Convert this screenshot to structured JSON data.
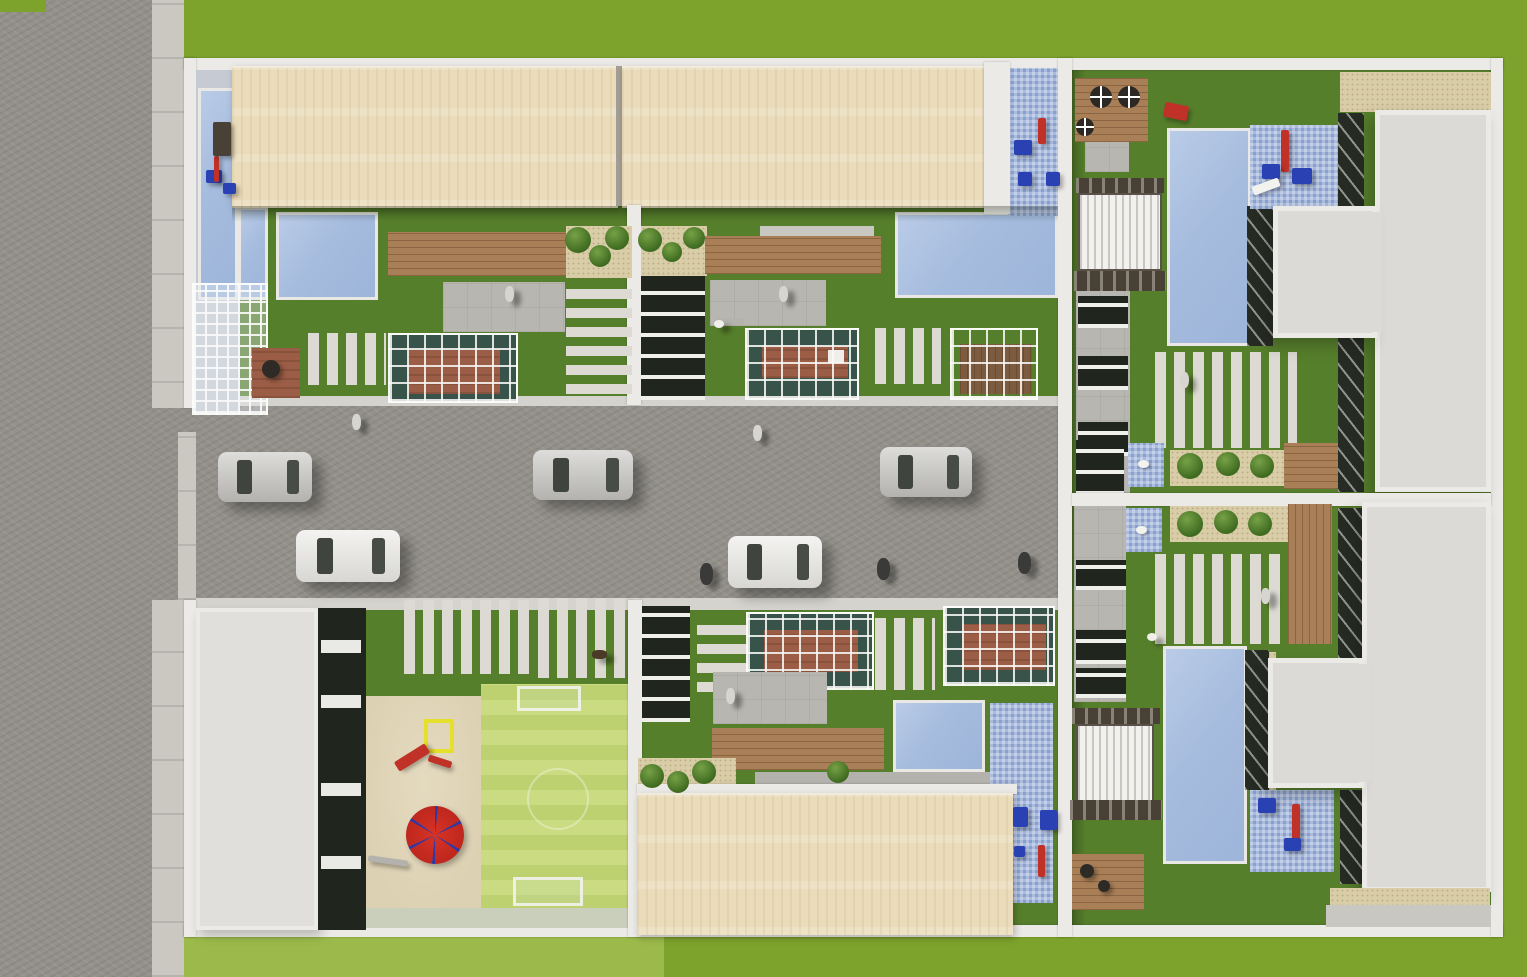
{
  "meta": {
    "description": "Top-down aerial 3D architectural rendering of a gated residential complex: two rows of townhouses along a central private street with cars, communal playground with red carousel and mini football pitch, private gardens with pools, pergolas, wooden decks and white slat walkways; public road and sidewalk on the left edge, lawn surrounding the site.",
    "image_type": "3d-render-aerial",
    "visible_text": ""
  },
  "palette": {
    "grass": "#7da32c",
    "grassLight": "#9cba4b",
    "lawn": "#567f2b",
    "asphalt": "#94918b",
    "walk": "#cbc8c1",
    "wall": "#eceae7",
    "terrace": "#c6cbd3",
    "roofBeige": "#eadcba",
    "roofWhite": "#dbdad7",
    "roofWhiteEdge": "#eceae7",
    "pool": "#a6bcde",
    "splash": "#a9bbdf",
    "deck": "#a97f57",
    "patio": "#b8b6b1",
    "gravel": "#d9cda7",
    "darkGlass": "#20251d",
    "slat": "#dcdad2",
    "pitch": "#bdd171",
    "pitchStripe": "#cadb81",
    "sand": "#ddd1b3",
    "sandboxYellow": "#e4e02b",
    "carouselRed": "#c9291e",
    "playBlue": "#2a41b4",
    "playRed": "#c03227",
    "brick": "#9b5d45",
    "louver": "#f2f1ee",
    "frameDark": "#4a4136",
    "stepGray": "#c9c7c2",
    "stepGray2": "#b4b2ad",
    "carSilver": "#c2c1bd",
    "carWhite": "#eae9e5",
    "figLight": "#d6d5d0",
    "figDark": "#3a3a38",
    "swan": "#f2f2ee"
  },
  "inventory": {
    "cars_on_street": 5,
    "building_blocks": 4,
    "beige_roof_rows": 2,
    "white_villa_roofs": 2,
    "pools_and_water_features": 10,
    "pergolas_with_louvers": 2,
    "playgrounds": 4,
    "mini_football_pitch": 1,
    "red_carousel": 1
  },
  "cars": [
    {
      "x": 218,
      "y": 452,
      "w": 94,
      "h": 50,
      "color": "carSilver"
    },
    {
      "x": 296,
      "y": 530,
      "w": 104,
      "h": 52,
      "color": "carWhite"
    },
    {
      "x": 533,
      "y": 450,
      "w": 100,
      "h": 50,
      "color": "carSilver"
    },
    {
      "x": 728,
      "y": 536,
      "w": 94,
      "h": 52,
      "color": "carWhite"
    },
    {
      "x": 880,
      "y": 447,
      "w": 92,
      "h": 50,
      "color": "carSilver"
    }
  ],
  "people": [
    {
      "x": 352,
      "y": 414,
      "kind": "pedestrian-light"
    },
    {
      "x": 753,
      "y": 425,
      "kind": "pedestrian-light"
    },
    {
      "x": 700,
      "y": 563,
      "kind": "rider-dark"
    },
    {
      "x": 877,
      "y": 558,
      "kind": "rider-dark"
    },
    {
      "x": 1018,
      "y": 552,
      "kind": "rider-dark"
    },
    {
      "x": 505,
      "y": 286,
      "kind": "pedestrian-light"
    },
    {
      "x": 779,
      "y": 286,
      "kind": "pedestrian-light"
    },
    {
      "x": 726,
      "y": 688,
      "kind": "pedestrian-light"
    },
    {
      "x": 1180,
      "y": 372,
      "kind": "pedestrian-light"
    },
    {
      "x": 1261,
      "y": 588,
      "kind": "pedestrian-light"
    },
    {
      "x": 592,
      "y": 650,
      "kind": "dog"
    },
    {
      "x": 714,
      "y": 320,
      "kind": "bird"
    },
    {
      "x": 1147,
      "y": 633,
      "kind": "bird"
    }
  ],
  "bushes": [
    {
      "x": 578,
      "y": 240,
      "r": 13
    },
    {
      "x": 600,
      "y": 256,
      "r": 11
    },
    {
      "x": 617,
      "y": 238,
      "r": 12
    },
    {
      "x": 650,
      "y": 240,
      "r": 12
    },
    {
      "x": 672,
      "y": 252,
      "r": 10
    },
    {
      "x": 694,
      "y": 238,
      "r": 11
    },
    {
      "x": 652,
      "y": 776,
      "r": 12
    },
    {
      "x": 678,
      "y": 782,
      "r": 11
    },
    {
      "x": 704,
      "y": 772,
      "r": 12
    },
    {
      "x": 1190,
      "y": 466,
      "r": 13
    },
    {
      "x": 1228,
      "y": 464,
      "r": 12
    },
    {
      "x": 1262,
      "y": 466,
      "r": 12
    },
    {
      "x": 1190,
      "y": 524,
      "r": 13
    },
    {
      "x": 1226,
      "y": 522,
      "r": 12
    },
    {
      "x": 1260,
      "y": 524,
      "r": 12
    },
    {
      "x": 838,
      "y": 772,
      "r": 11
    }
  ],
  "stairs": [
    {
      "x": 321,
      "y": 640
    },
    {
      "x": 321,
      "y": 695
    },
    {
      "x": 321,
      "y": 783
    },
    {
      "x": 321,
      "y": 856
    }
  ],
  "swans": [
    {
      "x": 1138,
      "y": 460
    },
    {
      "x": 1136,
      "y": 526
    }
  ],
  "tables": [
    {
      "x": 1090,
      "y": 86,
      "d": 22
    },
    {
      "x": 1118,
      "y": 86,
      "d": 22
    },
    {
      "x": 1076,
      "y": 118,
      "d": 18
    }
  ],
  "grills": [
    {
      "x": 262,
      "y": 360,
      "d": 18
    },
    {
      "x": 1080,
      "y": 864,
      "d": 14
    },
    {
      "x": 1098,
      "y": 880,
      "d": 12
    }
  ],
  "play_items": [
    {
      "x": 206,
      "y": 170,
      "w": 16,
      "h": 13,
      "c": "playBlue"
    },
    {
      "x": 214,
      "y": 156,
      "w": 5,
      "h": 26,
      "c": "playRed"
    },
    {
      "x": 223,
      "y": 183,
      "w": 13,
      "h": 11,
      "c": "playBlue"
    },
    {
      "x": 213,
      "y": 122,
      "w": 18,
      "h": 34,
      "c": "frameDark"
    },
    {
      "x": 1014,
      "y": 140,
      "w": 18,
      "h": 15,
      "c": "playBlue"
    },
    {
      "x": 1038,
      "y": 118,
      "w": 8,
      "h": 26,
      "c": "playRed"
    },
    {
      "x": 1018,
      "y": 172,
      "w": 14,
      "h": 14,
      "c": "playBlue"
    },
    {
      "x": 1046,
      "y": 172,
      "w": 14,
      "h": 14,
      "c": "playBlue"
    },
    {
      "x": 1281,
      "y": 130,
      "w": 8,
      "h": 42,
      "c": "playRed"
    },
    {
      "x": 1262,
      "y": 164,
      "w": 18,
      "h": 15,
      "c": "playBlue"
    },
    {
      "x": 1292,
      "y": 168,
      "w": 20,
      "h": 16,
      "c": "playBlue"
    },
    {
      "x": 1252,
      "y": 182,
      "w": 28,
      "h": 9,
      "c": "swan",
      "rot": -20
    },
    {
      "x": 1292,
      "y": 804,
      "w": 8,
      "h": 36,
      "c": "playRed"
    },
    {
      "x": 1258,
      "y": 798,
      "w": 18,
      "h": 15,
      "c": "playBlue"
    },
    {
      "x": 1284,
      "y": 838,
      "w": 17,
      "h": 13,
      "c": "playBlue"
    },
    {
      "x": 1013,
      "y": 807,
      "w": 15,
      "h": 20,
      "c": "playBlue"
    },
    {
      "x": 1040,
      "y": 810,
      "w": 17,
      "h": 20,
      "c": "playBlue"
    },
    {
      "x": 1038,
      "y": 845,
      "w": 7,
      "h": 32,
      "c": "playRed"
    },
    {
      "x": 1014,
      "y": 846,
      "w": 11,
      "h": 11,
      "c": "playBlue"
    },
    {
      "x": 394,
      "y": 752,
      "w": 36,
      "h": 11,
      "c": "playRed",
      "rot": -32
    },
    {
      "x": 428,
      "y": 758,
      "w": 24,
      "h": 7,
      "c": "playRed",
      "rot": 18
    },
    {
      "x": 368,
      "y": 858,
      "w": 40,
      "h": 6,
      "c": "stepGray2",
      "rot": 8
    },
    {
      "x": 1164,
      "y": 104,
      "w": 24,
      "h": 15,
      "c": "playRed",
      "rot": 12
    }
  ]
}
